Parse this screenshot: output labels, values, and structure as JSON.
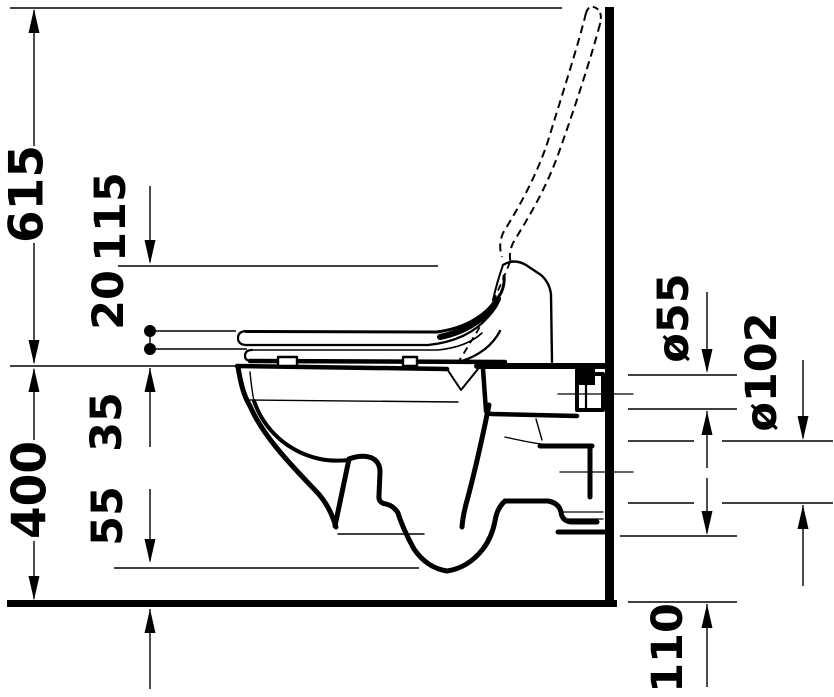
{
  "drawing": {
    "type": "technical-dimension-drawing",
    "subject": "wall-hung-toilet-side-view",
    "colors": {
      "line": "#000000",
      "background": "#ffffff"
    },
    "dimensions": {
      "d615": "615",
      "d115": "115",
      "d20": "20",
      "d35": "35",
      "d400": "400",
      "d55": "55",
      "dia55": "ø55",
      "dia102": "ø102",
      "d110": "110"
    }
  }
}
